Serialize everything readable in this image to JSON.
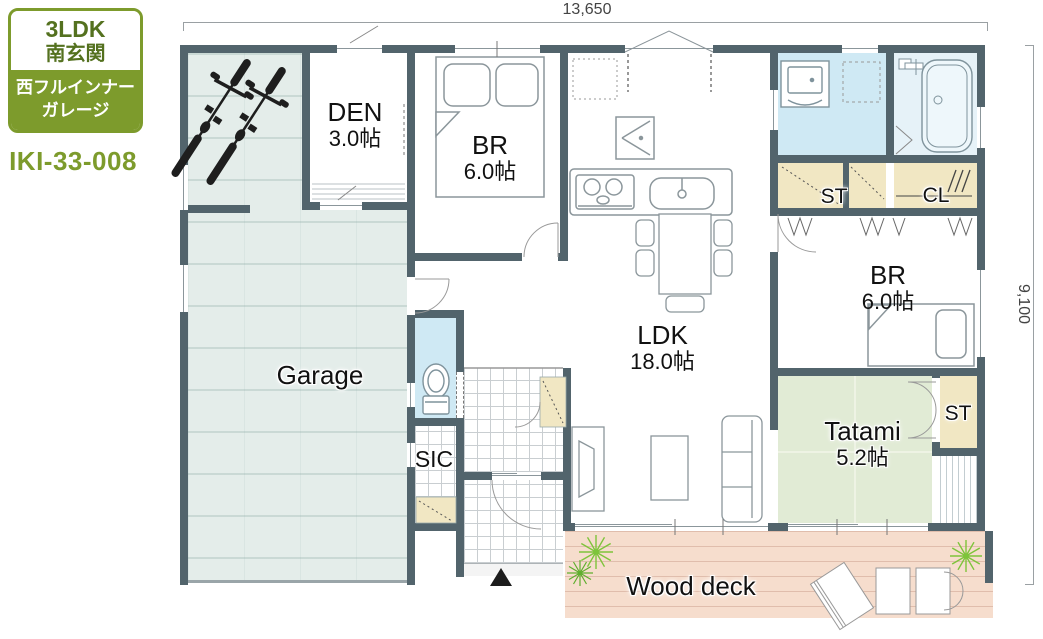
{
  "badge": {
    "type": "3LDK",
    "entrance": "南玄関",
    "feature_line1": "西フルインナー",
    "feature_line2": "ガレージ",
    "plan_code": "IKI-33-008"
  },
  "dimensions": {
    "width": "13,650",
    "height": "9,100"
  },
  "rooms": {
    "garage": {
      "label": "Garage"
    },
    "den": {
      "label": "DEN",
      "size": "3.0帖"
    },
    "br1": {
      "label": "BR",
      "size": "6.0帖"
    },
    "ldk": {
      "label": "LDK",
      "size": "18.0帖"
    },
    "br2": {
      "label": "BR",
      "size": "6.0帖"
    },
    "tatami": {
      "label": "Tatami",
      "size": "5.2帖"
    },
    "sic": {
      "label": "SIC"
    },
    "st1": {
      "label": "ST"
    },
    "cl": {
      "label": "CL"
    },
    "st2": {
      "label": "ST"
    },
    "wood_deck": {
      "label": "Wood deck"
    }
  },
  "colors": {
    "accent_green": "#7d9b2c",
    "wall": "#52646c",
    "water_floor": "#cfe9f4",
    "tatami_floor": "#e1ebd5",
    "storage_floor": "#f1e7c3",
    "deck_floor": "#f6ddcd",
    "garage_floor": "#e4edea",
    "plant_green": "#7ec43b"
  }
}
